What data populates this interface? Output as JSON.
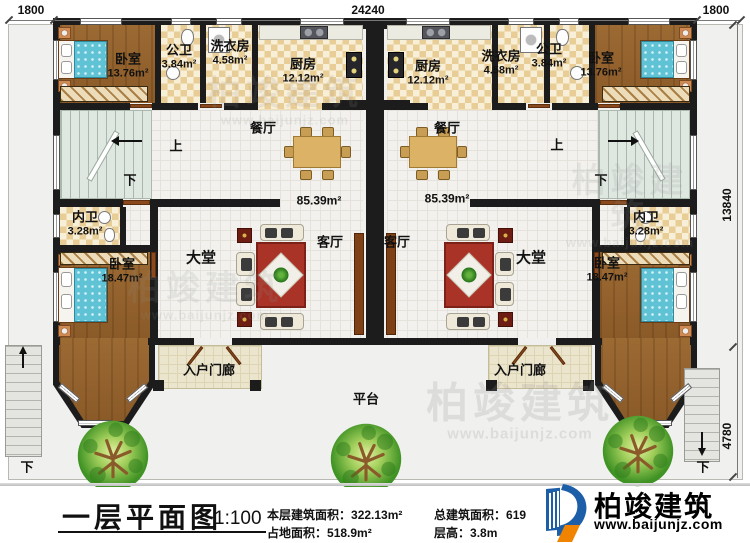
{
  "plan": {
    "dims": {
      "top_left": "1800",
      "top_center": "24240",
      "top_right": "1800",
      "right_upper": "13840",
      "right_lower": "4780"
    },
    "rooms": {
      "bedroom_top": {
        "name": "卧室",
        "area": "13.76m²"
      },
      "public_bath": {
        "name": "公卫",
        "area": "3.84m²"
      },
      "laundry": {
        "name": "洗衣房",
        "area": "4.58m²"
      },
      "kitchen": {
        "name": "厨房",
        "area": "12.12m²"
      },
      "dining": {
        "name": "餐厅"
      },
      "hall": {
        "name": "大堂"
      },
      "living": {
        "name": "客厅"
      },
      "inner_bath": {
        "name": "内卫",
        "area": "3.28m²"
      },
      "bedroom_bottom": {
        "name": "卧室",
        "area": "18.47m²"
      },
      "porch": {
        "name": "入户门廊"
      },
      "platform": {
        "name": "平台"
      },
      "unit_area": "85.39m²"
    },
    "stairs": {
      "up": "上",
      "down": "下"
    }
  },
  "watermark": {
    "name": "柏竣建筑",
    "url": "www.baijunjz.com"
  },
  "footer": {
    "title": "一层平面图",
    "scale": "1:100",
    "stats": {
      "floor_area_label": "本层建筑面积：",
      "floor_area": "322.13m²",
      "land_area_label": "占地面积：",
      "land_area": "518.9m²",
      "total_area_label": "总建筑面积：",
      "total_area": "619",
      "height_label": "层高：",
      "height": "3.8m"
    },
    "brand": {
      "name": "柏竣建筑",
      "url": "www.baijunjz.com"
    }
  },
  "colors": {
    "wall": "#1c1c1c",
    "brand_blue": "#1c5fa8",
    "brand_orange": "#f08300"
  }
}
